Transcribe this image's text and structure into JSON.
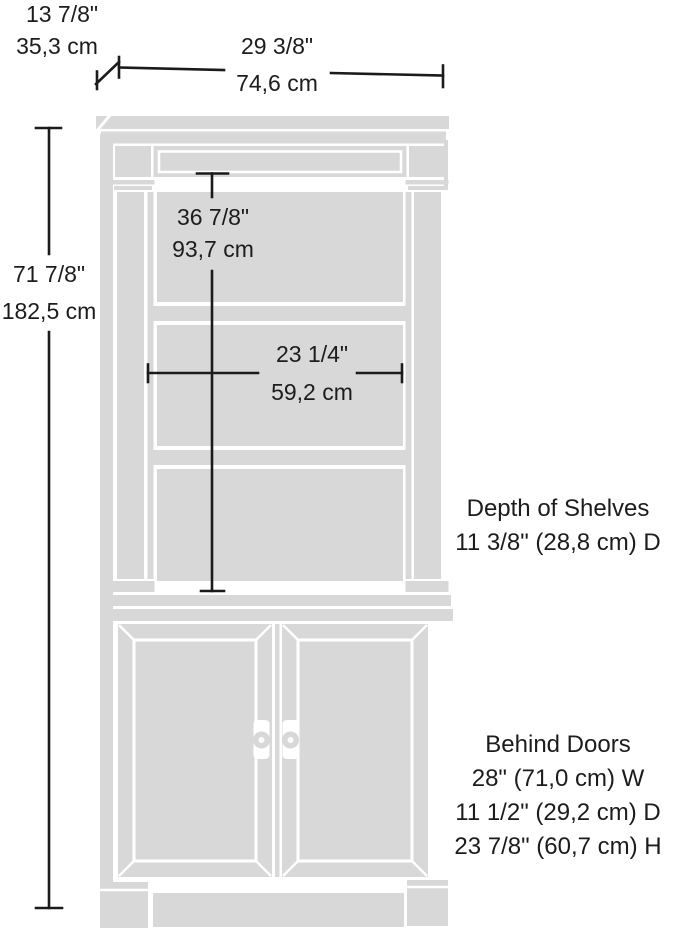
{
  "diagram_title": "Bookcase with doors - dimension diagram",
  "colors": {
    "cabinet_fill": "#d8d8d8",
    "dimension_line": "#1b1b1b",
    "background": "#ffffff",
    "text": "#1c1c1c"
  },
  "dimensions": {
    "depth_top": {
      "inches": "13 7/8\"",
      "cm": "35,3 cm"
    },
    "width_top": {
      "inches": "29 3/8\"",
      "cm": "74,6 cm"
    },
    "height_left": {
      "inches": "71 7/8\"",
      "cm": "182,5 cm"
    },
    "upper_interior_height": {
      "inches": "36 7/8\"",
      "cm": "93,7 cm"
    },
    "interior_width": {
      "inches": "23 1/4\"",
      "cm": "59,2 cm"
    }
  },
  "notes": {
    "shelf_depth": {
      "title": "Depth of Shelves",
      "value": "11 3/8\" (28,8 cm) D"
    },
    "behind_doors": {
      "title": "Behind Doors",
      "lines": [
        "28\" (71,0 cm) W",
        "11 1/2\" (29,2 cm) D",
        "23 7/8\" (60,7 cm) H"
      ]
    }
  }
}
